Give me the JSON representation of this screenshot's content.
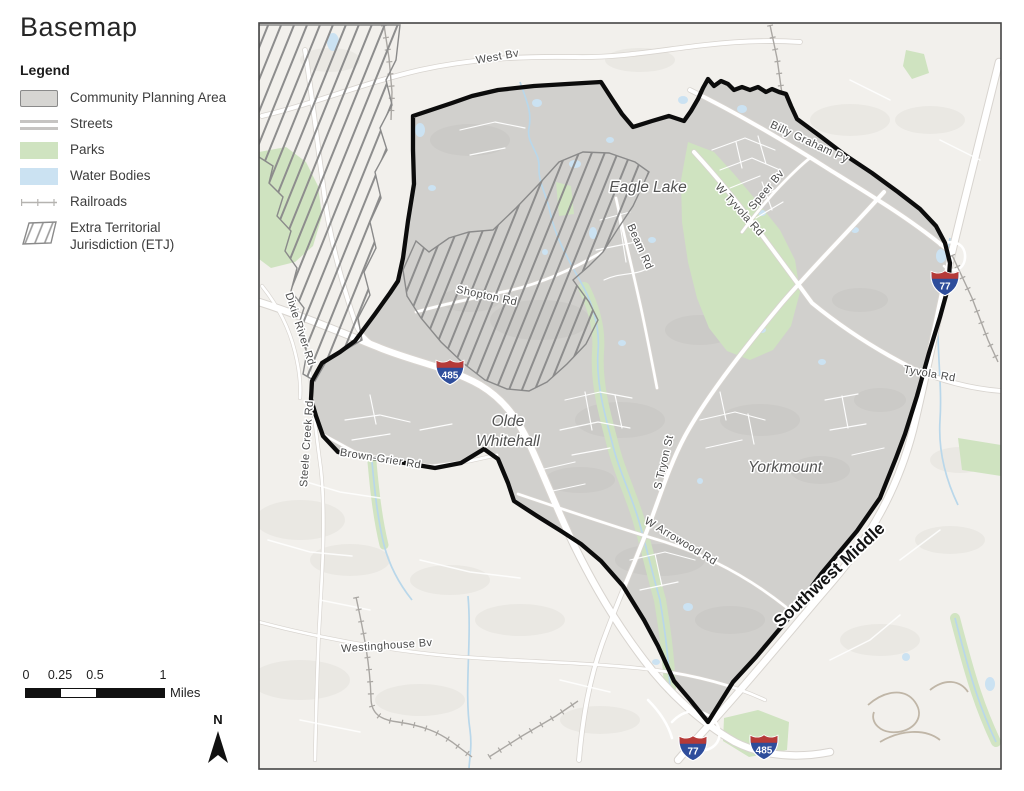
{
  "title": "Basemap",
  "legend": {
    "heading": "Legend",
    "items": [
      {
        "label": "Community Planning Area"
      },
      {
        "label": "Streets"
      },
      {
        "label": "Parks"
      },
      {
        "label": "Water Bodies"
      },
      {
        "label": "Railroads"
      },
      {
        "label": "Extra Territorial Jurisdiction (ETJ)"
      }
    ]
  },
  "map": {
    "area_labels": {
      "eagle_lake": "Eagle Lake",
      "olde_whitehall_1": "Olde",
      "olde_whitehall_2": "Whitehall",
      "yorkmount": "Yorkmount"
    },
    "road_labels": {
      "west_bv": "West Bv",
      "billy_graham_py": "Billy Graham Py",
      "w_tyvola_rd": "W Tyvola Rd",
      "speer_bv": "Speer Bv",
      "beam_rd": "Beam Rd",
      "shopton_rd": "Shopton Rd",
      "dixie_river_rd": "Dixie River Rd",
      "steele_creek_rd": "Steele Creek Rd",
      "brown_grier_rd": "Brown-Grier Rd",
      "s_tryon_st": "S Tryon St",
      "w_arrowood_rd": "W Arrowood Rd",
      "tyvola_rd": "Tyvola Rd",
      "westinghouse_bv": "Westinghouse Bv",
      "southwest_middle": "Southwest Middle"
    },
    "shields": {
      "i77": "77",
      "i485": "485"
    }
  },
  "scale_bar": {
    "ticks": [
      "0",
      "0.25",
      "0.5",
      "1"
    ],
    "unit": "Miles"
  },
  "north_arrow": {
    "label": "N"
  },
  "colors": {
    "planning_area_fill": "#d1d0cd",
    "boundary": "#0c0c0c",
    "parks": "#cfe3c0",
    "water": "#cbe2f2",
    "etj_hatch": "#8d8d8d",
    "outside_background": "#f2f0ec",
    "shield_blue": "#2e4d9b",
    "shield_red": "#b53a38"
  }
}
